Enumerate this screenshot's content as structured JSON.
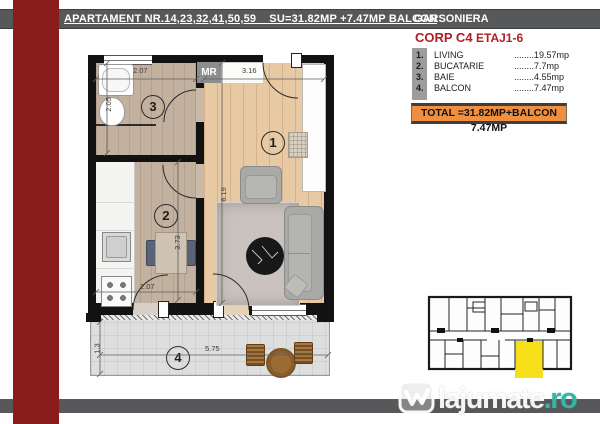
{
  "colors": {
    "header_bar": "#57585a",
    "accent_red_bar": "#8a1c1c",
    "brand_red_text": "#b01e23",
    "total_box_bg": "#ef8f3f",
    "highlight_unit_yellow": "#f6e019",
    "watermark_teal": "#2fb7ad",
    "wall_black": "#121212"
  },
  "header": {
    "title": "APARTAMENT NR.14,23,32,41,50,59    SU=31.82MP +7.47MP BALCON",
    "type_label": "GARSONIERA"
  },
  "info": {
    "corp": "CORP C4",
    "etaj": "ETAJ1-6",
    "legend": [
      {
        "num": "1.",
        "name": "LIVING",
        "value": "........19.57mp"
      },
      {
        "num": "2.",
        "name": "BUCATARIE",
        "value": "........7.7mp"
      },
      {
        "num": "3.",
        "name": "BAIE",
        "value": "........4.55mp"
      },
      {
        "num": "4.",
        "name": "BALCON",
        "value": "........7.47mp"
      }
    ],
    "total": "TOTAL =31.82MP+BALCON 7.47MP"
  },
  "plan": {
    "mr_label": "MR",
    "rooms": [
      {
        "number": "1",
        "name": "living"
      },
      {
        "number": "2",
        "name": "bucatarie"
      },
      {
        "number": "3",
        "name": "baie"
      },
      {
        "number": "4",
        "name": "balcon"
      }
    ],
    "dimensions": {
      "bath_width": "2.07",
      "bath_height": "2.05",
      "living_width": "3.16",
      "living_height": "6.19",
      "kitchen_length": "3.73",
      "kitchen_width": "2.07",
      "balcony_depth": "1.3",
      "balcony_length": "5.75"
    }
  },
  "watermark": {
    "site": "lajumate",
    "tld": ".ro"
  }
}
